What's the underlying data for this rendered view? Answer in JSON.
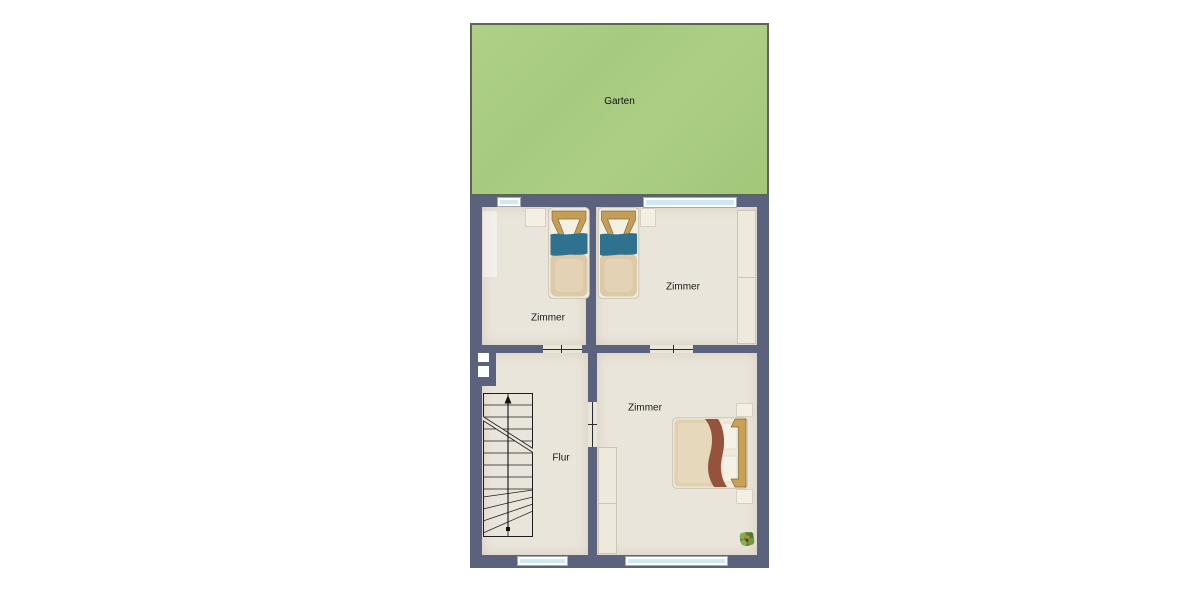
{
  "garden": {
    "label": "Garten",
    "color": "#a9cd84"
  },
  "rooms": {
    "top_left": {
      "label": "Zimmer"
    },
    "top_right": {
      "label": "Zimmer"
    },
    "bottom": {
      "label": "Zimmer"
    },
    "hallway": {
      "label": "Flur"
    }
  },
  "palette": {
    "wall": "#5b627e",
    "floor": "#eae5da",
    "garden_green": "#a9cd84",
    "garden_border": "#5d6652",
    "window_glass": "#cfe9f2",
    "bed_blanket_teal": "#2e7290",
    "bed_blanket_sienna": "#95523d",
    "headboard_wood": "#c49d58",
    "text": "#1a1a1a"
  },
  "icons": [
    "single-bed-icon",
    "double-bed-icon",
    "stairs-icon",
    "plant-icon",
    "window",
    "door-opening"
  ]
}
